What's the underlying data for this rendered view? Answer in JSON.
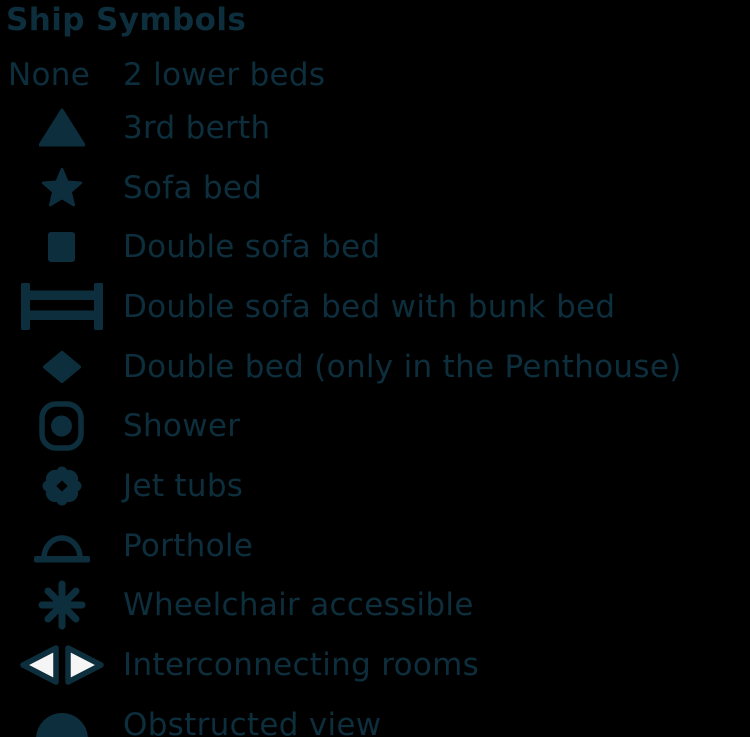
{
  "colors": {
    "background": "#000000",
    "ink": "#0d2e3c",
    "interconnecting_fill": "#f5f5f5"
  },
  "header": {
    "title": "Ship Symbols"
  },
  "legend": {
    "rows": [
      {
        "icon": "none-text",
        "icon_text": "None",
        "label": "2 lower beds"
      },
      {
        "icon": "triangle-icon",
        "label": "3rd berth"
      },
      {
        "icon": "star-icon",
        "label": "Sofa bed"
      },
      {
        "icon": "square-icon",
        "label": "Double sofa bed"
      },
      {
        "icon": "bunk-bed-icon",
        "label": "Double sofa bed with bunk bed"
      },
      {
        "icon": "diamond-icon",
        "label": "Double bed (only in the Penthouse)"
      },
      {
        "icon": "shower-icon",
        "label": "Shower"
      },
      {
        "icon": "jet-tubs-icon",
        "label": "Jet tubs"
      },
      {
        "icon": "porthole-icon",
        "label": "Porthole"
      },
      {
        "icon": "asterisk-icon",
        "label": "Wheelchair accessible"
      },
      {
        "icon": "interconnecting-icon",
        "label": "Interconnecting rooms"
      },
      {
        "icon": "obstructed-view-icon",
        "label": "Obstructed view"
      }
    ]
  }
}
